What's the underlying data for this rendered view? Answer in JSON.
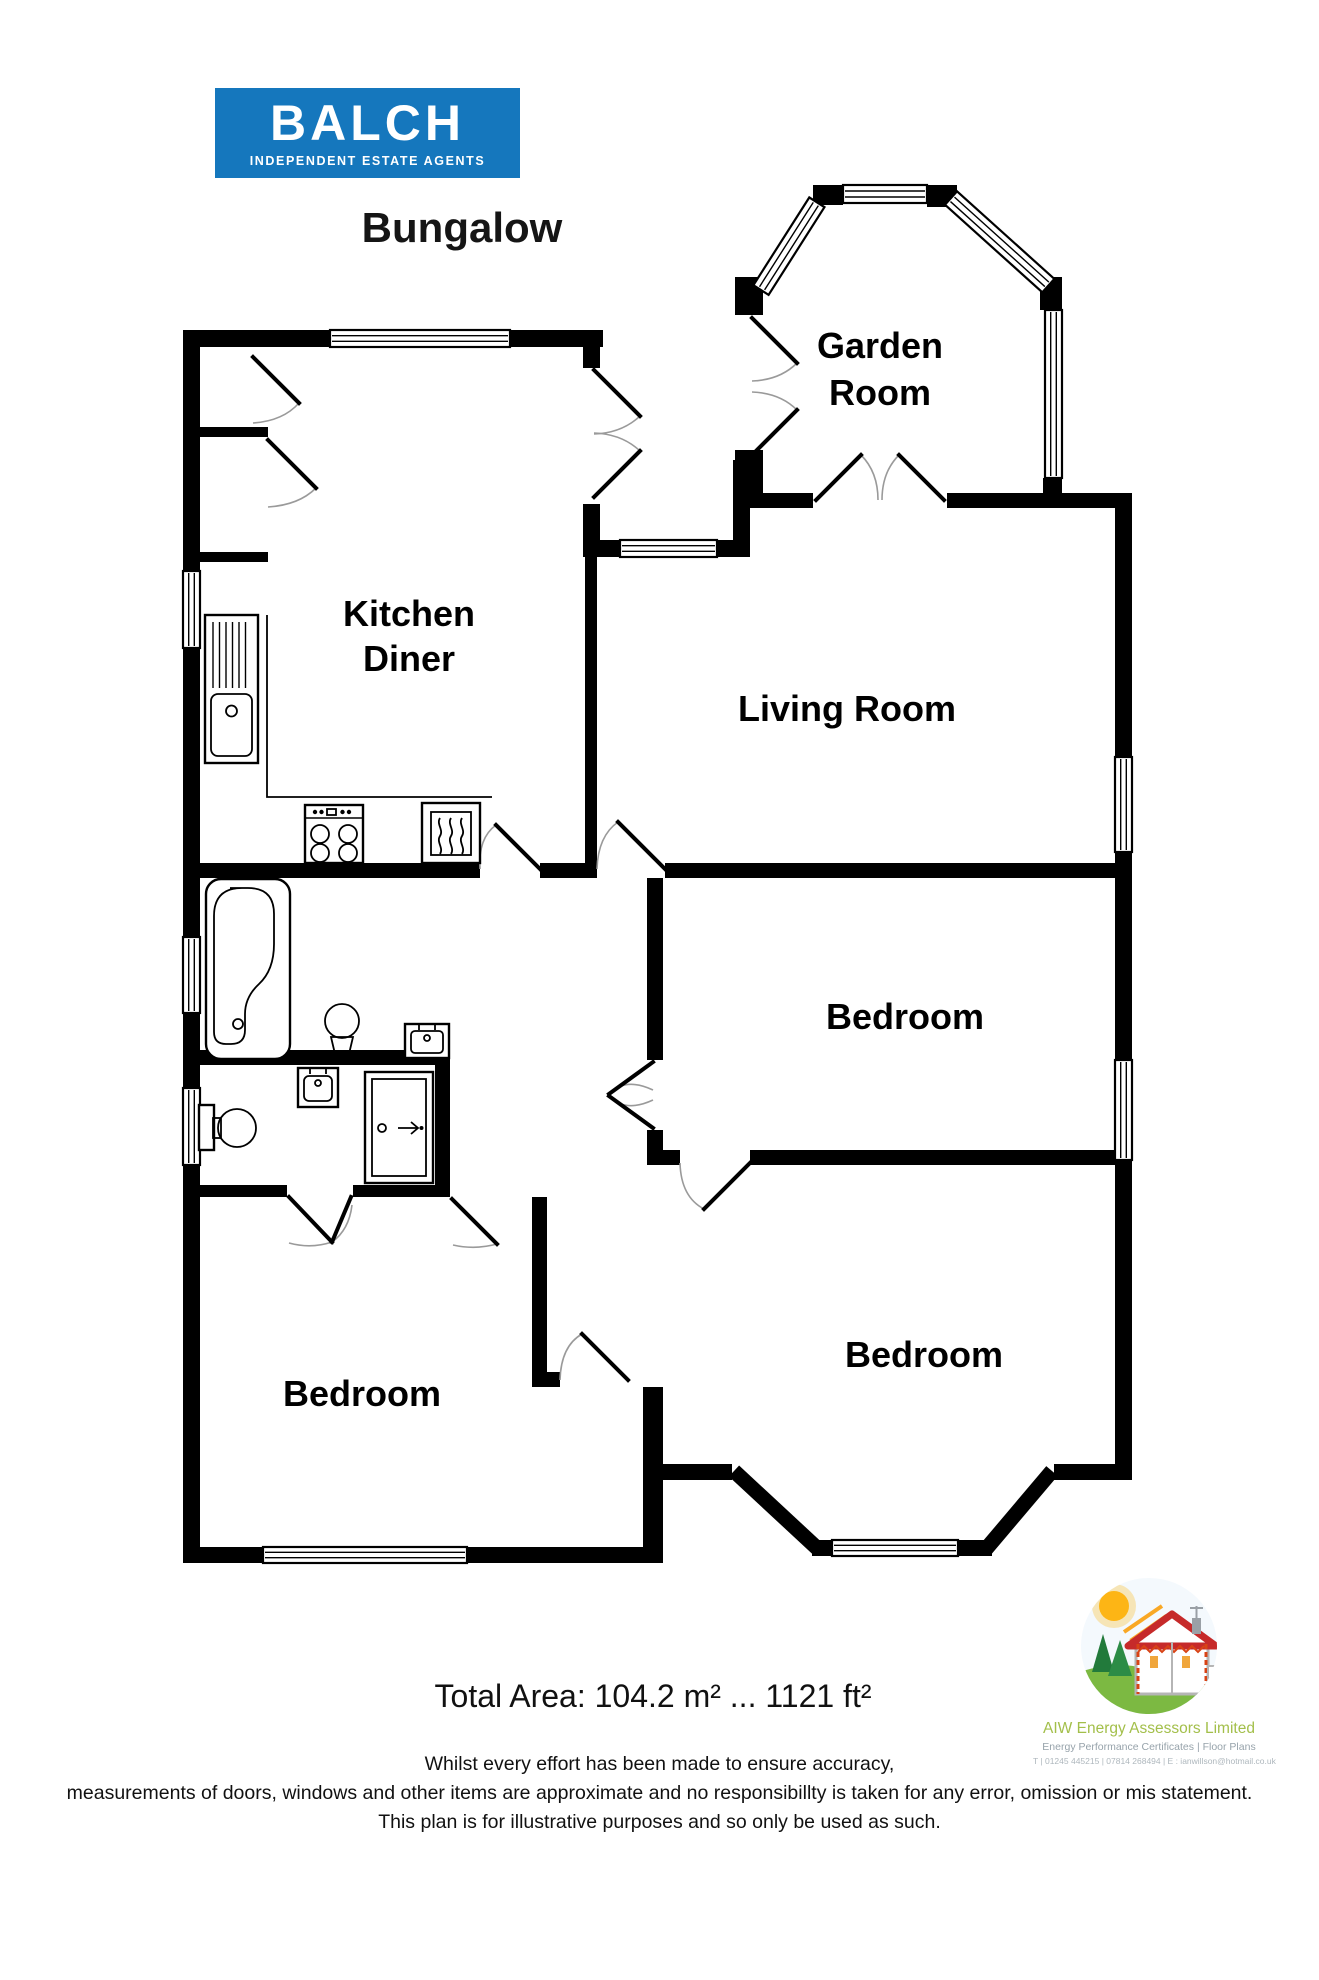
{
  "branding": {
    "name": "BALCH",
    "tagline": "INDEPENDENT ESTATE AGENTS",
    "color": "#1577bd"
  },
  "title": "Bungalow",
  "rooms": {
    "garden_room": {
      "line1": "Garden",
      "line2": "Room"
    },
    "kitchen_diner": {
      "line1": "Kitchen",
      "line2": "Diner"
    },
    "living_room": {
      "label": "Living Room"
    },
    "bedroom_right": {
      "label": "Bedroom"
    },
    "bedroom_bottom_right": {
      "label": "Bedroom"
    },
    "bedroom_bottom_left": {
      "label": "Bedroom"
    }
  },
  "total_area": "Total Area: 104.2 m² ... 1121 ft²",
  "disclaimer": {
    "line1": "Whilst every effort has been made to ensure accuracy,",
    "line2": "measurements of doors, windows and other items are approximate and no responsibillty is taken for any error, omission or mis statement.",
    "line3": "This plan is for illustrative purposes and so only be used as such."
  },
  "assessor": {
    "name": "AIW Energy Assessors Limited",
    "services": "Energy Performance Certificates | Floor Plans",
    "contact": "T | 01245 445215 | 07814 268494 | E : ianwillson@hotmail.co.uk",
    "name_color": "#a3bf4a"
  }
}
